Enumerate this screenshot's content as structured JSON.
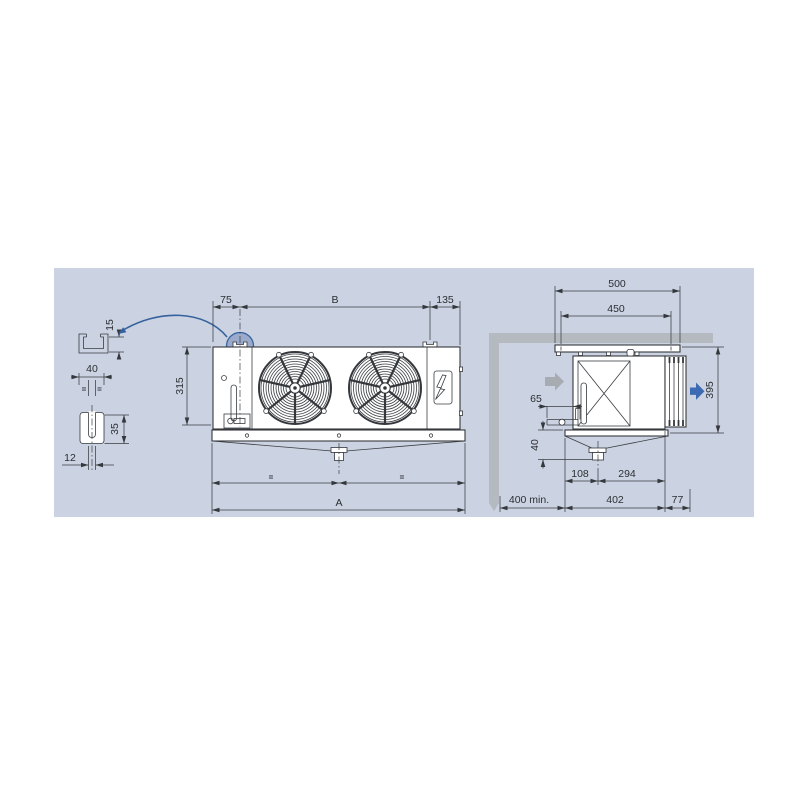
{
  "front_view": {
    "dim_offset_left": "75",
    "dim_fans_span": "B",
    "dim_offset_right": "135",
    "dim_height": "315",
    "dim_equal_left": "=",
    "dim_equal_right": "=",
    "dim_total_width": "A"
  },
  "bracket_detail": {
    "dim_lip_height": "15",
    "dim_width": "40",
    "dim_equal_left": "=",
    "dim_equal_right": "=",
    "dim_slot_height": "35",
    "dim_slot_width": "12"
  },
  "side_view": {
    "dim_plate_width": "500",
    "dim_holes_spacing": "450",
    "dim_height": "395",
    "dim_pipe_stub": "65",
    "dim_tray_height": "40",
    "dim_drain_offset": "108",
    "dim_drain_to_back": "294",
    "dim_wall_clearance": "400 min.",
    "dim_depth": "402",
    "dim_fan_guard_depth": "77"
  },
  "colors": {
    "panel_background": "#cbd2e1",
    "line": "#34383c",
    "accent_blue": "#3d6bb3",
    "highlight_circle_fill": "rgba(77,105,166,0.38)",
    "highlight_circle_stroke": "#35629f",
    "wall_gray": "#b5bac1",
    "air_in_arrow_gray": "#a7acb3"
  }
}
